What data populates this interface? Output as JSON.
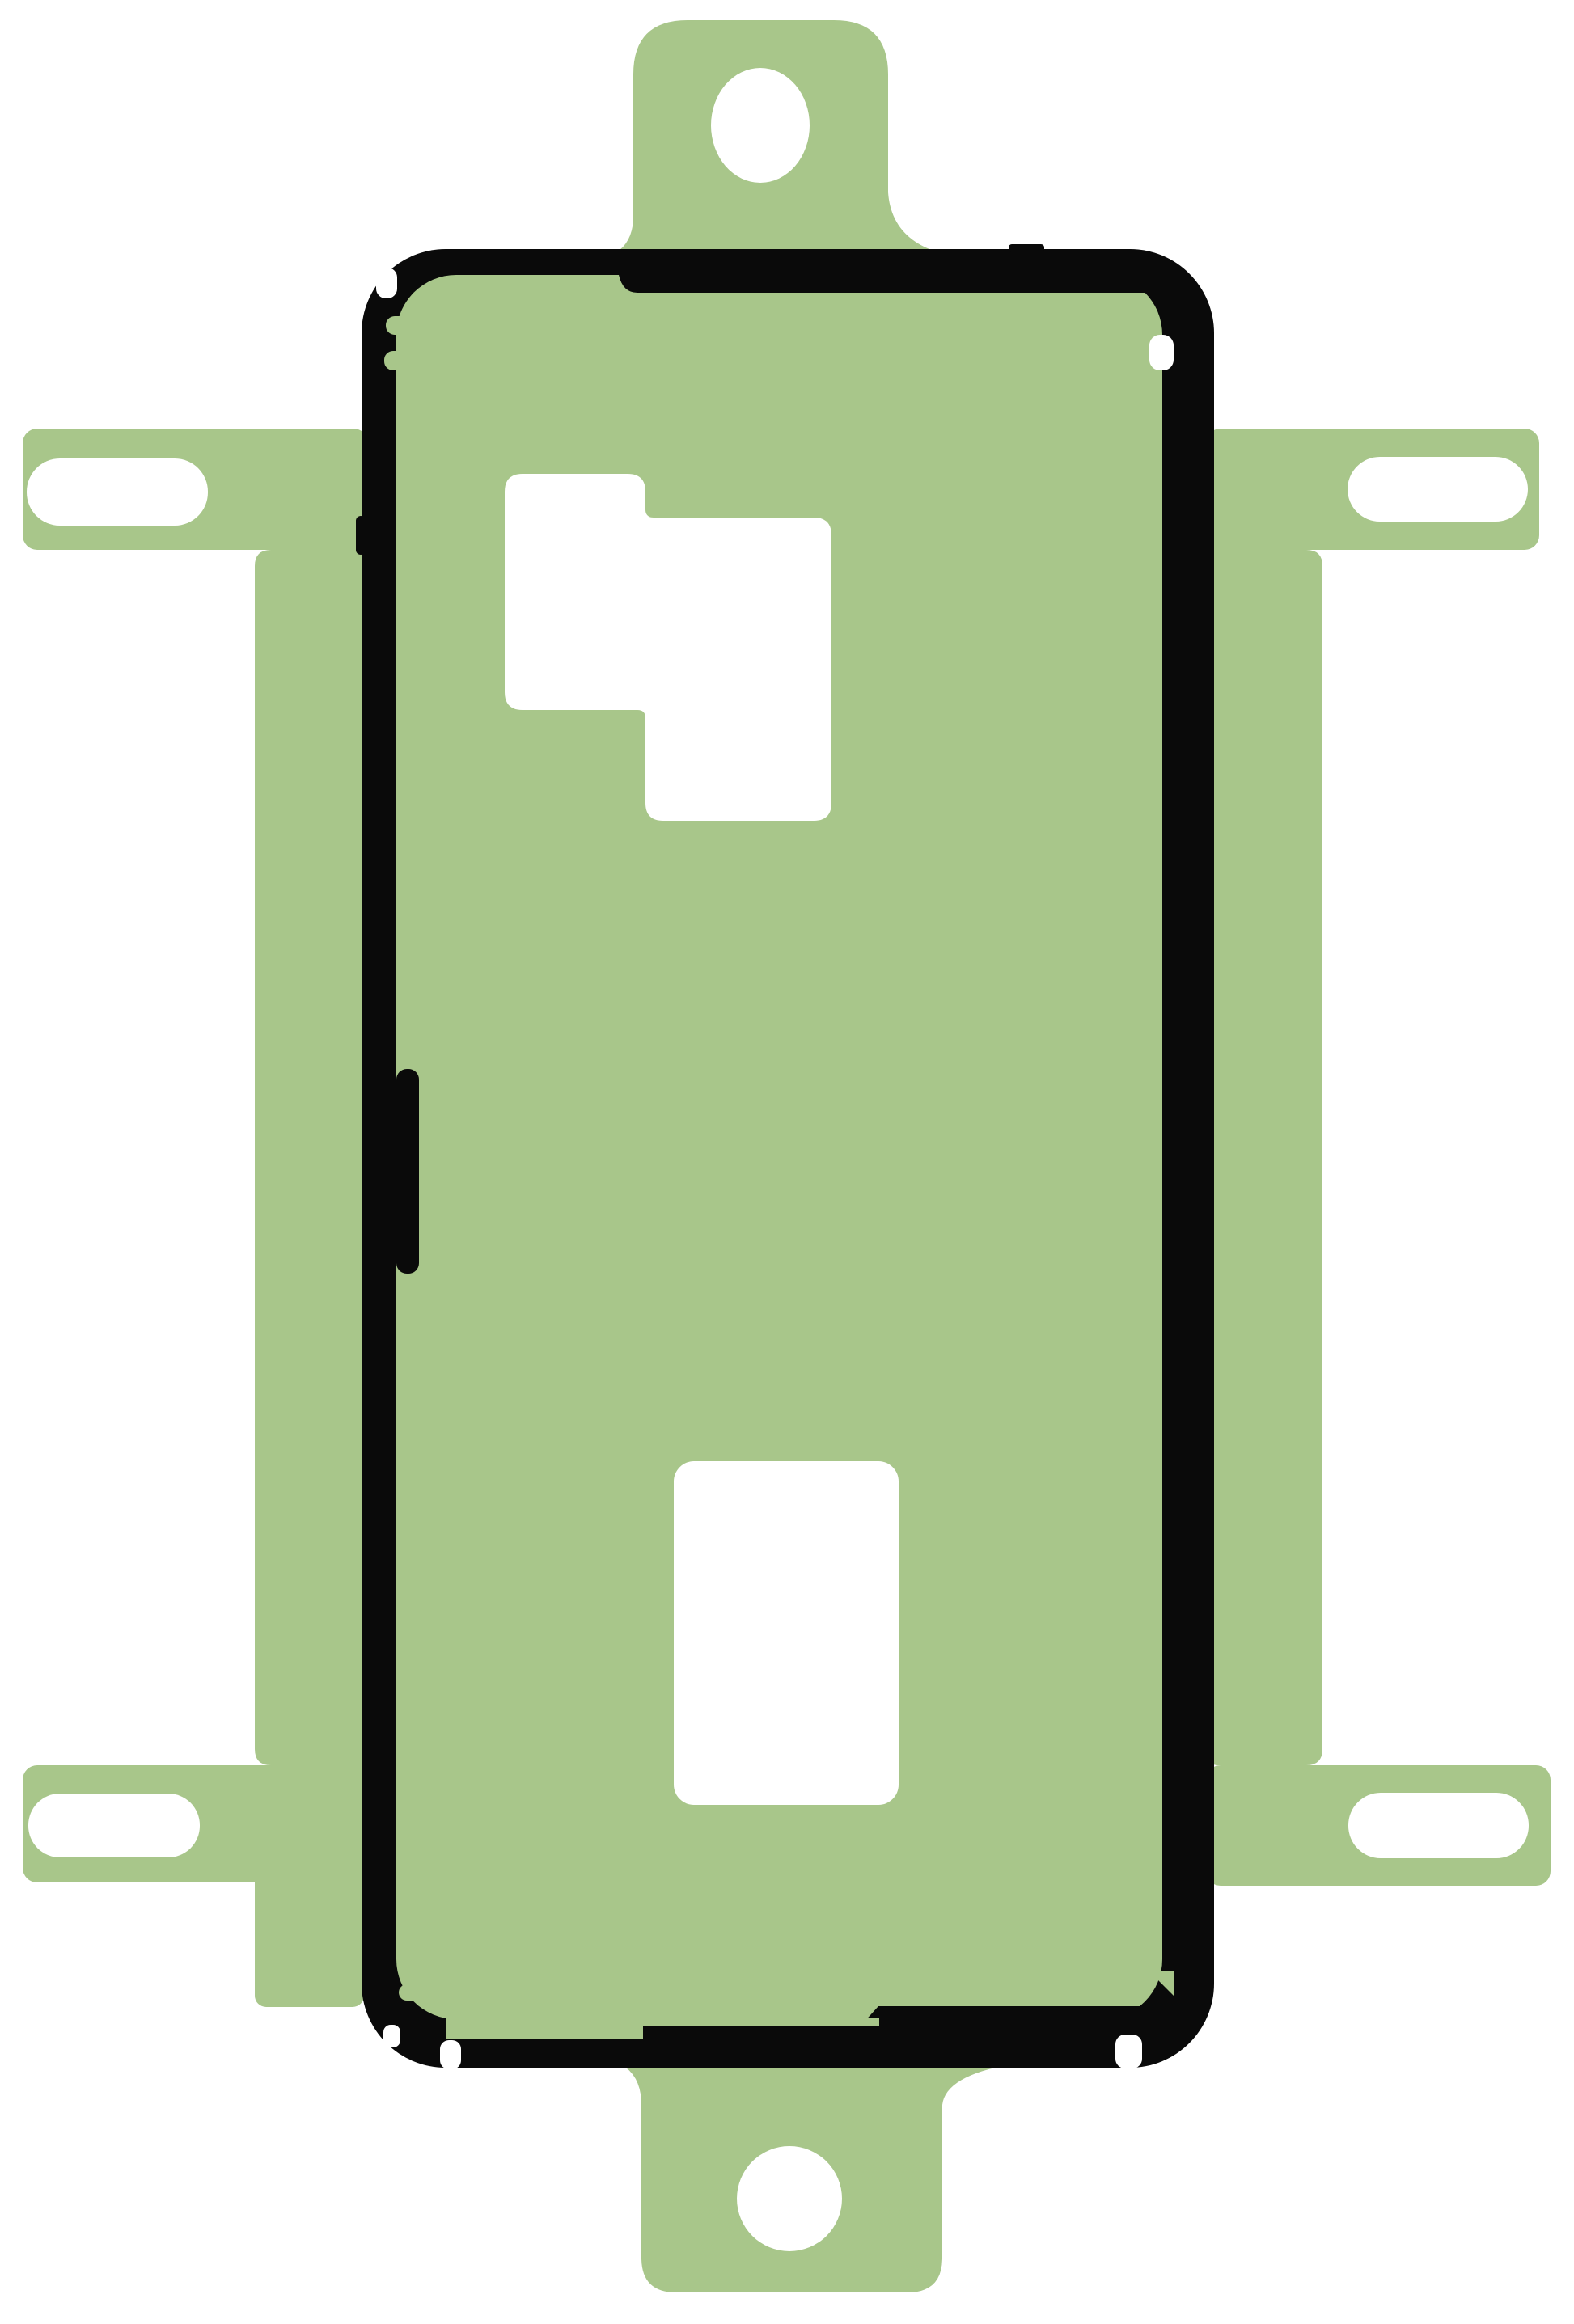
{
  "colors": {
    "background": "#ffffff",
    "film": "#a8c68a",
    "outline": "#0a0a0a",
    "cutout": "#ffffff"
  }
}
